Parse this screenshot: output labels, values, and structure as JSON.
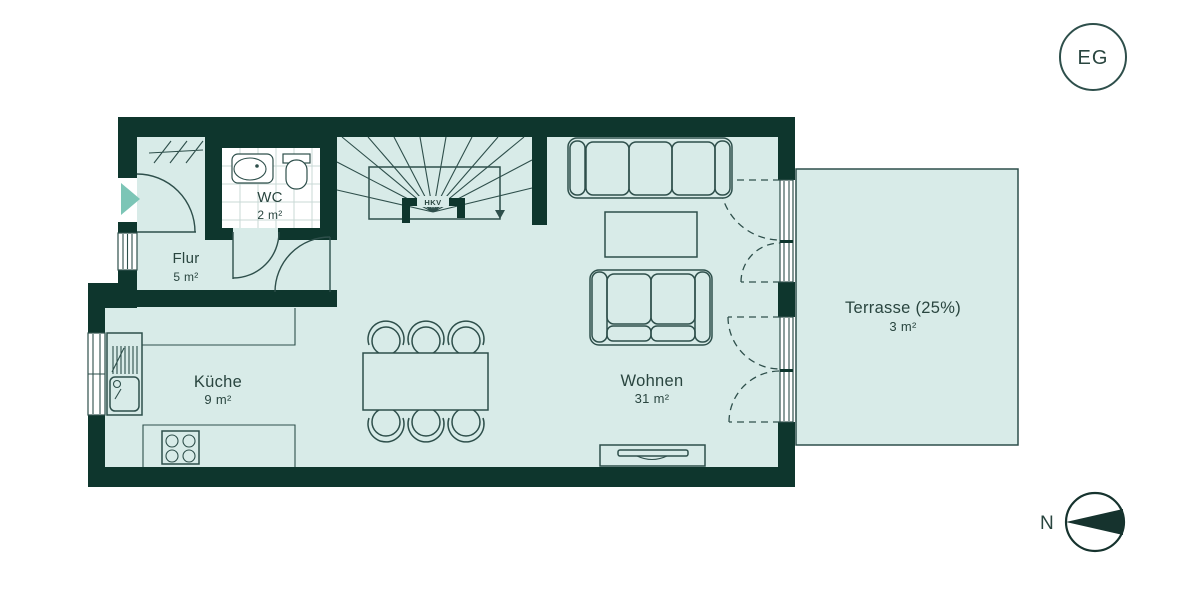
{
  "plan": {
    "floor_badge": "EG",
    "compass_north": "N",
    "stair_annotation": "HKV",
    "rooms": {
      "flur": {
        "name": "Flur",
        "area": "5 m²"
      },
      "wc": {
        "name": "WC",
        "area": "2 m²"
      },
      "kueche": {
        "name": "Küche",
        "area": "9 m²"
      },
      "wohnen": {
        "name": "Wohnen",
        "area": "31 m²"
      },
      "terrasse": {
        "name": "Terrasse (25%)",
        "area": "3 m²"
      }
    },
    "colors": {
      "wall": "#0e362d",
      "floor": "#d8ebe8",
      "line": "#2e4f4b",
      "text": "#29453f",
      "entrance_arrow": "#7cc5b6",
      "wc_floor": "#ffffff",
      "tile_line": "#c9d9d5",
      "background": "#ffffff"
    }
  }
}
